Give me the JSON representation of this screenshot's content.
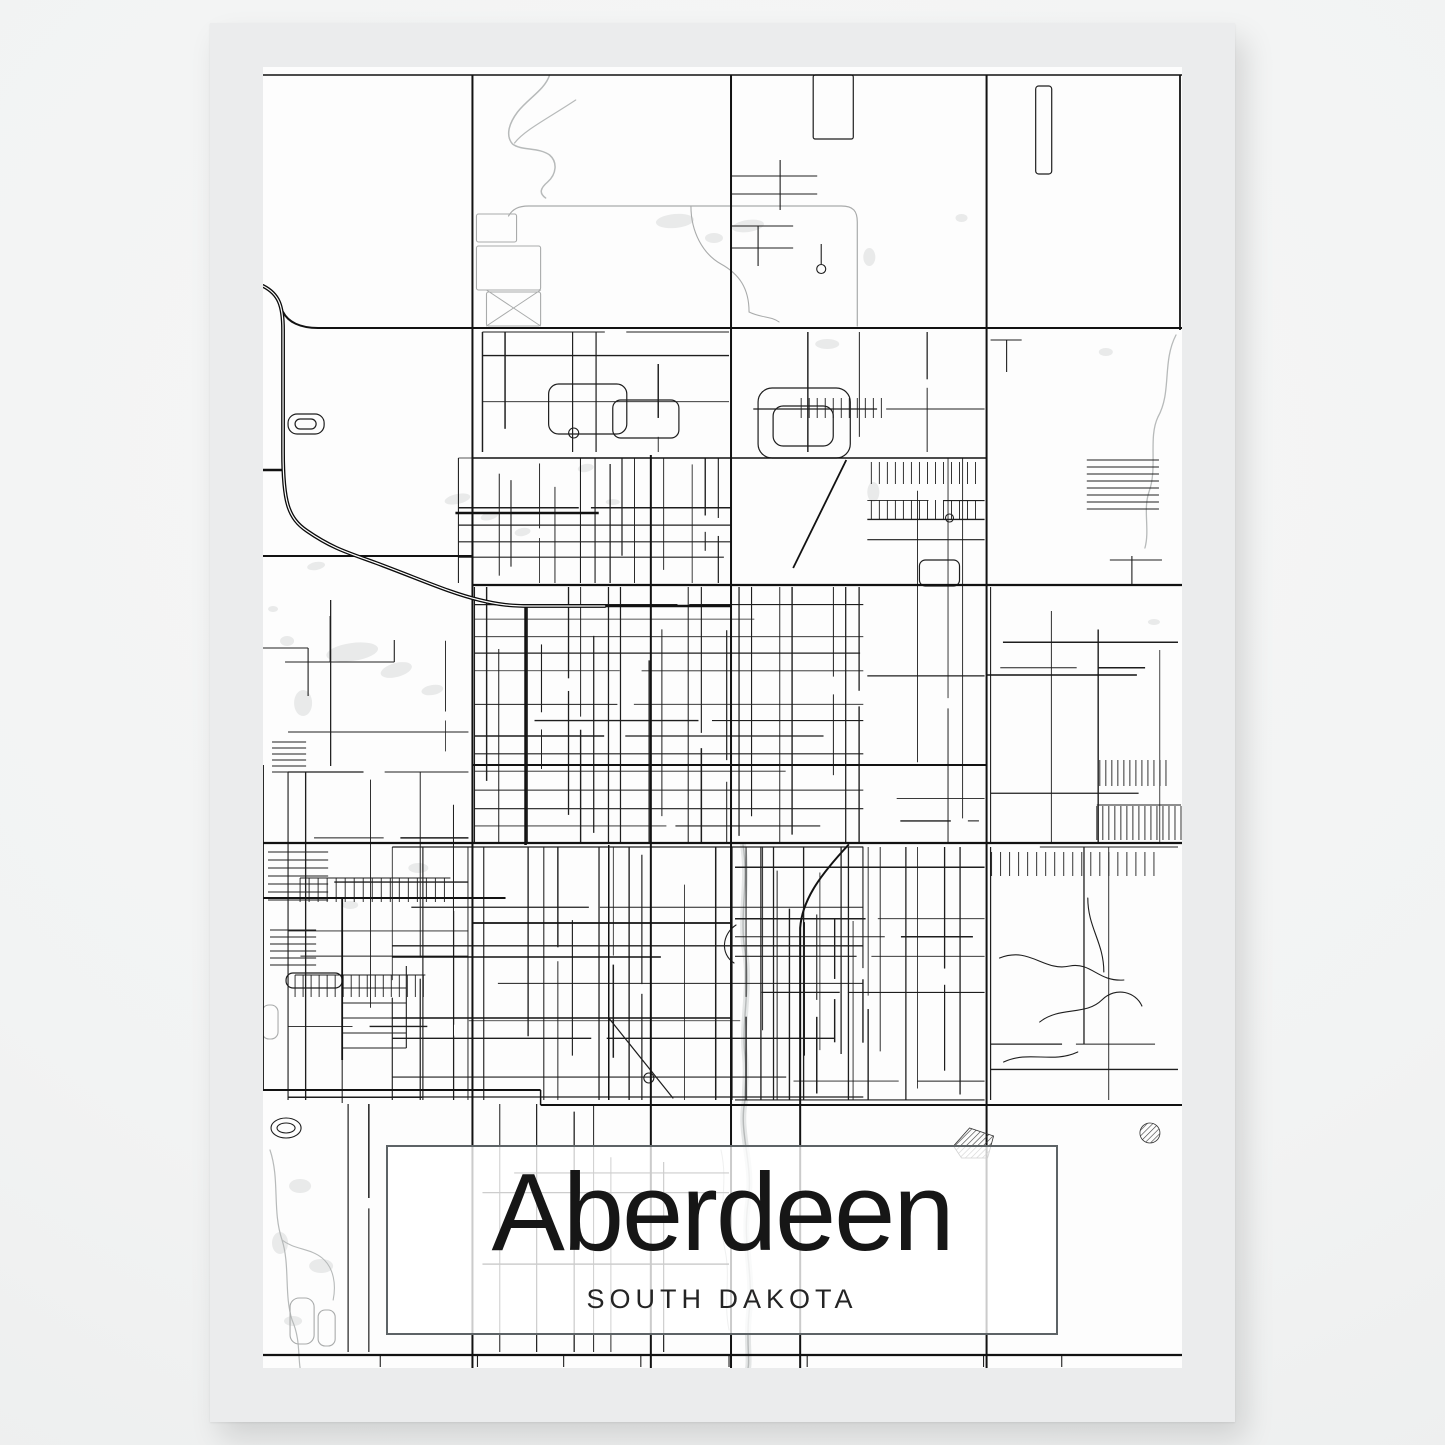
{
  "poster": {
    "title": "Aberdeen",
    "subtitle": "SOUTH DAKOTA"
  },
  "colors": {
    "page_background": "#f6f7f7",
    "page_background_edge": "#eaecec",
    "poster_margin": "#ebeced",
    "map_background": "#fdfdfd",
    "road_minor": "#1e1e1e",
    "road_major": "#121212",
    "railroad": "#0b0b0b",
    "road_gray": "#a9abab",
    "water_line": "#b7baba",
    "water_band": "#e4e6e6",
    "pond_fill": "#e9eaea",
    "title_box_border": "#5d6366",
    "title_box_fill": "rgba(255,255,255,0.78)",
    "title_text": "#161616",
    "subtitle_text": "#242424"
  },
  "map": {
    "viewbox": [
      263,
      67,
      917,
      1301
    ],
    "majors": [
      [
        472,
        75,
        472,
        1368,
        2
      ],
      [
        730,
        75,
        730,
        1368,
        2
      ],
      [
        985,
        75,
        985,
        1368,
        2
      ],
      [
        1178,
        75,
        1178,
        330,
        1.8
      ],
      [
        263,
        75,
        1180,
        75,
        1.5
      ],
      [
        318,
        328,
        1180,
        328,
        2
      ],
      [
        263,
        556,
        472,
        556,
        2
      ],
      [
        472,
        585,
        1180,
        585,
        2.2
      ],
      [
        472,
        458,
        985,
        458,
        1.6
      ],
      [
        263,
        843,
        1180,
        843,
        2.2
      ],
      [
        263,
        898,
        505,
        898,
        2
      ],
      [
        263,
        1090,
        540,
        1090,
        2
      ],
      [
        540,
        1090,
        540,
        1105,
        1.5
      ],
      [
        540,
        1105,
        1180,
        1105,
        2
      ],
      [
        263,
        1355,
        1180,
        1355,
        2.2
      ],
      [
        650,
        455,
        650,
        1368,
        2
      ],
      [
        525,
        605,
        525,
        845,
        2.6
      ],
      [
        455,
        513,
        598,
        513,
        2.4
      ],
      [
        518,
        606,
        730,
        606,
        2.4
      ],
      [
        472,
        765,
        985,
        765,
        2
      ],
      [
        985,
        675,
        1135,
        675,
        1.6
      ],
      [
        472,
        923,
        730,
        923,
        1.7
      ],
      [
        392,
        957,
        660,
        957,
        1.5
      ],
      [
        392,
        1018,
        730,
        1018,
        1.4
      ],
      [
        608,
        845,
        608,
        1100,
        1.5
      ],
      [
        845,
        460,
        792,
        568,
        1.8
      ],
      [
        342,
        898,
        342,
        1060,
        1.8
      ],
      [
        342,
        1060,
        342,
        1103,
        1
      ],
      [
        263,
        765,
        263,
        1090,
        1.8
      ],
      [
        263,
        470,
        284,
        470,
        2.5
      ]
    ],
    "major_paths": [
      [
        "M 283,312 C 288,322 300,328 318,328",
        2
      ],
      [
        "M 847,845 C 822,872 801,898 799,928 L 799,1368",
        2
      ]
    ],
    "railroad": "M 263,286 C 279,294 283,306 283,330 L 283,452 C 283,502 288,518 307,531 C 333,549 349,553 376,563 C 424,581 450,593 479,600 C 499,605 512,606 529,606 L 604,606",
    "river": "M 742,845 C 748,882 738,916 744,952 C 750,986 740,1022 744,1056 C 746,1078 743,1090 744,1100 C 737,1133 753,1163 747,1203 C 741,1243 753,1273 748,1313 C 745,1343 749,1359 747,1368",
    "creeks": [
      [
        "M 549,75 C 544,90 528,98 517,112 C 508,124 505,136 512,144 C 521,151 538,147 549,155 C 557,162 556,174 547,182 C 540,188 538,193 545,198",
        1.5
      ],
      [
        "M 514,143 C 524,130 548,118 575,100",
        1.2
      ],
      [
        "M 1174,335 C 1160,362 1170,392 1156,417 C 1146,438 1156,468 1147,492 C 1141,510 1148,530 1143,548",
        1.3
      ],
      [
        "M 720,1150 C 728,1185 716,1215 724,1250 C 730,1278 722,1300 728,1330",
        1
      ],
      [
        "M 270,1150 C 280,1180 272,1210 282,1240 C 290,1265 284,1295 292,1320",
        1.2
      ],
      [
        "M 292,1320 C 300,1338 298,1355 300,1368",
        1.2
      ],
      [
        "M 282,1240 C 295,1250 310,1248 322,1258 C 334,1268 336,1285 333,1300",
        1.1
      ]
    ],
    "gray_paths": [
      [
        "M 508,216 C 512,209 518,206 528,206 L 840,206 C 852,206 856,211 856,222 L 856,326",
        1.2
      ],
      [
        "M 690,206 C 690,232 702,254 720,264 C 738,274 748,288 748,312",
        1.1
      ],
      [
        "M 748,312 C 760,318 770,316 778,322",
        1
      ],
      [
        "M 540,290 L 486,326",
        1
      ],
      [
        "M 486,290 L 540,326",
        1
      ]
    ],
    "black_paths": [
      [
        "M 998,958 C 1028,946 1042,972 1068,966 C 1090,962 1096,982 1122,980",
        1.1
      ],
      [
        "M 1038,1022 C 1058,1006 1084,1016 1100,1000 C 1114,986 1134,992 1140,1006",
        1.1
      ],
      [
        "M 1002,1062 C 1028,1050 1050,1064 1076,1052",
        1.1
      ],
      [
        "M 1086,898 C 1086,928 1102,942 1102,972",
        1.1
      ],
      [
        "M 608,1018 L 672,1098",
        1.2
      ],
      [
        "M 735,925 C 721,934 719,954 733,963",
        1.1
      ]
    ],
    "stubs": [
      [
        730,
        176,
        816,
        176
      ],
      [
        730,
        194,
        816,
        194
      ],
      [
        779,
        160,
        779,
        210
      ],
      [
        730,
        226,
        792,
        226
      ],
      [
        757,
        226,
        757,
        266
      ],
      [
        730,
        248,
        792,
        248
      ],
      [
        820,
        244,
        820,
        264
      ],
      [
        263,
        648,
        308,
        648
      ],
      [
        308,
        648,
        308,
        696
      ],
      [
        330,
        616,
        330,
        662
      ],
      [
        285,
        662,
        394,
        662
      ],
      [
        394,
        640,
        394,
        662
      ],
      [
        989,
        340,
        1020,
        340
      ],
      [
        1005,
        340,
        1005,
        372
      ],
      [
        1130,
        556,
        1130,
        585
      ],
      [
        1108,
        560,
        1160,
        560
      ],
      [
        380,
        1355,
        380,
        1367
      ],
      [
        477,
        1355,
        477,
        1367
      ],
      [
        563,
        1355,
        563,
        1367
      ],
      [
        640,
        1355,
        640,
        1367
      ],
      [
        728,
        1355,
        728,
        1367
      ],
      [
        806,
        1355,
        806,
        1367
      ],
      [
        982,
        1355,
        982,
        1367
      ],
      [
        1060,
        1355,
        1060,
        1367
      ],
      [
        300,
        878,
        450,
        878
      ],
      [
        295,
        975,
        425,
        975
      ],
      [
        406,
        966,
        406,
        1048
      ],
      [
        1095,
        805,
        1179,
        805
      ]
    ],
    "combs_v": [
      [
        1095,
        806,
        84,
        34,
        6
      ],
      [
        1098,
        760,
        70,
        26,
        6
      ],
      [
        300,
        878,
        150,
        24,
        9
      ],
      [
        295,
        975,
        130,
        22,
        8
      ],
      [
        870,
        462,
        110,
        22,
        8
      ],
      [
        870,
        500,
        110,
        20,
        8
      ],
      [
        990,
        852,
        170,
        24,
        9
      ],
      [
        800,
        398,
        80,
        20,
        8
      ]
    ],
    "combs_h": [
      [
        1085,
        460,
        72,
        8,
        7
      ],
      [
        272,
        742,
        34,
        6,
        6
      ],
      [
        268,
        852,
        60,
        7,
        8
      ],
      [
        270,
        930,
        46,
        6,
        7
      ],
      [
        342,
        988,
        64,
        5,
        15
      ]
    ],
    "loops": [
      [
        548,
        384,
        78,
        50,
        10
      ],
      [
        612,
        400,
        66,
        38,
        8
      ],
      [
        757,
        388,
        92,
        70,
        14
      ],
      [
        772,
        406,
        60,
        40,
        10
      ],
      [
        812,
        75,
        40,
        64,
        2
      ],
      [
        1034,
        86,
        16,
        88,
        3
      ],
      [
        918,
        560,
        40,
        26,
        6
      ],
      [
        288,
        414,
        36,
        20,
        9
      ],
      [
        295,
        419,
        21,
        10,
        5
      ],
      [
        286,
        973,
        56,
        15,
        7
      ]
    ],
    "gray_loops": [
      [
        476,
        214,
        40,
        28,
        2
      ],
      [
        476,
        246,
        64,
        44,
        2
      ],
      [
        486,
        292,
        54,
        34,
        2
      ],
      [
        290,
        1298,
        24,
        46,
        9
      ],
      [
        318,
        1310,
        17,
        36,
        7
      ],
      [
        262,
        1005,
        16,
        34,
        7
      ]
    ],
    "circles": [
      [
        573,
        433,
        5
      ],
      [
        820,
        269,
        4.5
      ],
      [
        948,
        518,
        4
      ],
      [
        648,
        1078,
        5
      ]
    ],
    "stadium": [
      [
        286,
        1128,
        15,
        10
      ],
      [
        286,
        1128,
        9,
        5
      ]
    ],
    "hatch_polygon": "952,1146 968,1128 992,1136 986,1158 960,1158",
    "hatch_circle": [
      1148,
      1133,
      10
    ],
    "ponds": [
      [
        352,
        652,
        26,
        9,
        -8
      ],
      [
        396,
        670,
        16,
        7,
        -15
      ],
      [
        432,
        690,
        11,
        5,
        -10
      ],
      [
        303,
        703,
        9,
        13,
        0
      ],
      [
        287,
        641,
        7,
        5,
        0
      ],
      [
        316,
        566,
        9,
        4,
        -10
      ],
      [
        457,
        499,
        13,
        5,
        -12
      ],
      [
        489,
        516,
        9,
        4,
        -15
      ],
      [
        522,
        532,
        8,
        4,
        -10
      ],
      [
        612,
        502,
        7,
        3,
        0
      ],
      [
        674,
        221,
        19,
        7,
        -5
      ],
      [
        747,
        226,
        16,
        6,
        -8
      ],
      [
        713,
        238,
        9,
        5,
        0
      ],
      [
        868,
        257,
        6,
        9,
        0
      ],
      [
        960,
        218,
        6,
        4,
        0
      ],
      [
        1104,
        352,
        7,
        4,
        0
      ],
      [
        1152,
        622,
        6,
        3,
        0
      ],
      [
        826,
        344,
        12,
        5,
        0
      ],
      [
        872,
        492,
        6,
        10,
        0
      ],
      [
        585,
        468,
        8,
        4,
        -10
      ],
      [
        300,
        1186,
        11,
        7,
        0
      ],
      [
        280,
        1243,
        8,
        11,
        0
      ],
      [
        321,
        1266,
        12,
        7,
        0
      ],
      [
        293,
        1321,
        9,
        5,
        0
      ],
      [
        273,
        609,
        5,
        3,
        0
      ],
      [
        418,
        868,
        10,
        5,
        0
      ],
      [
        350,
        905,
        8,
        4,
        0
      ]
    ],
    "grids": [
      [
        458,
        458,
        730,
        583,
        13.5,
        16,
        0.8,
        0.75
      ],
      [
        474,
        587,
        862,
        843,
        13,
        16.5,
        0.85,
        0.8
      ],
      [
        392,
        847,
        862,
        1100,
        14.5,
        19,
        0.75,
        0.7
      ],
      [
        866,
        458,
        983,
        843,
        17,
        20,
        0.55,
        0.5
      ],
      [
        288,
        772,
        468,
        1100,
        16,
        23,
        0.5,
        0.5
      ],
      [
        482,
        332,
        728,
        452,
        21,
        24,
        0.4,
        0.45
      ],
      [
        734,
        332,
        983,
        452,
        24,
        26,
        0.28,
        0.3
      ],
      [
        734,
        847,
        983,
        1100,
        13.5,
        18,
        0.68,
        0.62
      ],
      [
        989,
        587,
        1176,
        843,
        22,
        26,
        0.3,
        0.35
      ],
      [
        989,
        847,
        1176,
        1100,
        24,
        28,
        0.25,
        0.3
      ],
      [
        482,
        1104,
        728,
        1352,
        17,
        22,
        0.45,
        0.4
      ],
      [
        288,
        1104,
        468,
        1352,
        20,
        26,
        0.3,
        0.3
      ],
      [
        288,
        600,
        468,
        766,
        22,
        26,
        0.2,
        0.25
      ]
    ]
  }
}
